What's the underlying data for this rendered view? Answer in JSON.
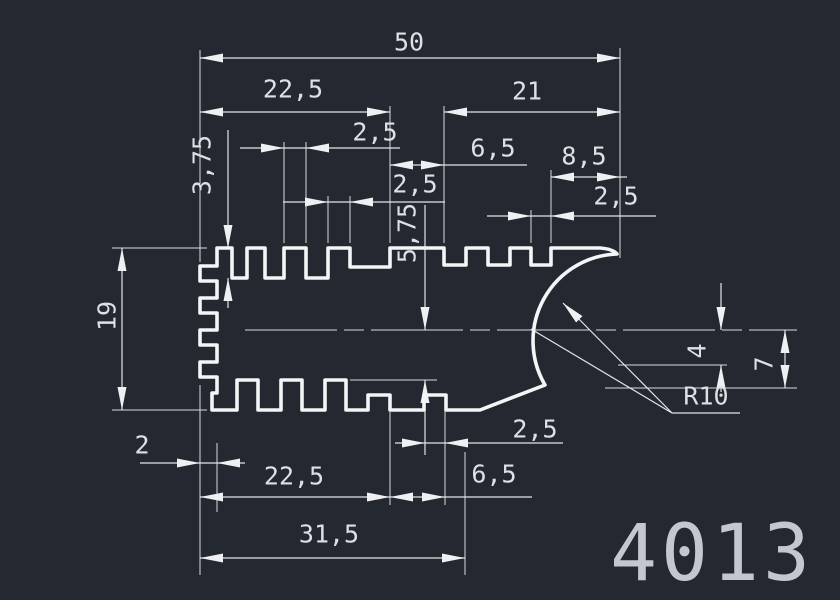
{
  "drawing": {
    "part_number": "4013",
    "colors": {
      "background": "#242830",
      "profile_line": "#f3f5f6",
      "dimension_line": "#d7dbdf",
      "text": "#dde1e5",
      "part_number_text": "#c3c8cf"
    },
    "dims": {
      "overall_width": "50",
      "top_span_left": "22,5",
      "top_span_right": "21",
      "top_fin_pitch": "2,5",
      "top_fin_width": "2,5",
      "top_offset_mid": "6,5",
      "top_plain_span": "8,5",
      "top_slot_last": "2,5",
      "top_slot_depth": "3,75",
      "mid_slot_depth": "5,75",
      "overall_height": "19",
      "right_step": "4",
      "right_edge_height": "7",
      "corner_radius": "R10",
      "tooth_depth": "2",
      "bottom_span_left": "22,5",
      "bottom_offset_mid": "6,5",
      "bottom_slot": "2,5",
      "bottom_span_wide": "31,5"
    }
  }
}
